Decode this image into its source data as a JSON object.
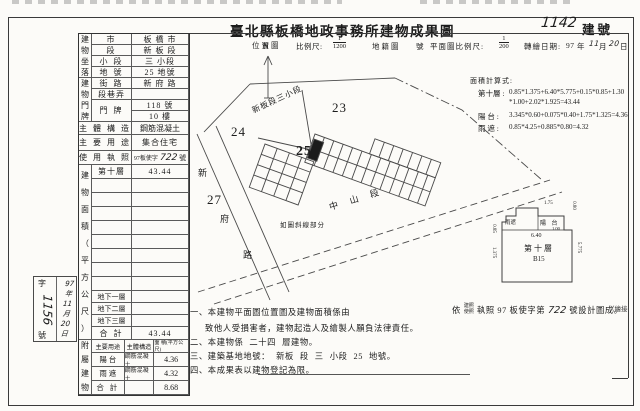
{
  "document": {
    "title": "臺北縣板橋地政事務所建物成果圖",
    "building_number": "1142",
    "building_number_label": "建號"
  },
  "scalebar": {
    "location_map": "位置圖",
    "scale_label": "比例尺:",
    "scale1_num": "1",
    "scale1_den": "1200",
    "cadastral_map": "地籍圖",
    "no_suffix": "號",
    "plan_scale_label": "平面圖比例尺:",
    "scale2_num": "1",
    "scale2_den": "200",
    "redraw_label": "轉繪日期:",
    "date_year": "97",
    "date_year_unit": "年",
    "date_month": "11",
    "date_month_unit": "月",
    "date_day": "20",
    "date_day_unit": "日"
  },
  "table": {
    "location": {
      "header": "建\n物\n坐\n落",
      "rows": [
        {
          "label": "市",
          "value": "板 橋 市"
        },
        {
          "label": "段",
          "value": "新 板 段"
        },
        {
          "label": "小 段",
          "value": "三 小段"
        },
        {
          "label": "地 號",
          "value": "25 地號"
        }
      ]
    },
    "address": {
      "header": "建\n物\n門\n牌",
      "street_label": "街 路",
      "street_value": "新 府 路",
      "lane_label": "段巷弄",
      "lane_value": "",
      "door_label": "門 牌",
      "door_value1": "118 號",
      "door_value2": "10 樓"
    },
    "structure": {
      "label": "主 體 構 造",
      "value": "鋼筋混凝土"
    },
    "usage": {
      "label": "主 要 用 途",
      "value": "集合住宅"
    },
    "license": {
      "label": "使 用 執 照",
      "prefix": "97板使字",
      "number": "722",
      "suffix": "號"
    },
    "area": {
      "header": "建\n物\n面\n積\n（\n平\n方\n公\n尺\n）",
      "floor_label": "第十層",
      "floor_value": "43.44",
      "b1": "地下一層",
      "b2": "地下二層",
      "b3": "地下三層",
      "total_label": "合  計",
      "total_value": "43.44"
    },
    "annex": {
      "header": "附\n屬\n建\n物",
      "col1": "主要用途",
      "col2": "主體構造",
      "col3": "面 積(平方公尺)",
      "rows": [
        {
          "use": "陽  台",
          "structure": "鋼筋混凝土",
          "area": "4.36"
        },
        {
          "use": "雨  遮",
          "structure": "鋼筋混凝土",
          "area": "4.32"
        }
      ],
      "total_label": "合  計",
      "total_value": "8.68"
    }
  },
  "calc": {
    "title": "面積計算式:",
    "floor_label": "第十層 :",
    "floor_formula1": "0.85*1.375+6.40*5.775+0.15*0.85+1.30",
    "floor_formula2": "*1.00+2.02*1.925=43.44",
    "balcony_label": "陽  台 :",
    "balcony_formula": "3.345*0.60+0.075*0.40+1.75*1.325=4.36",
    "canopy_label": "雨  遮 :",
    "canopy_formula": "0.85*4.25+0.885*0.80=4.32"
  },
  "map": {
    "compass": "N",
    "section_label": "新板段三小段",
    "parcel_23": "23",
    "parcel_24": "24",
    "parcel_25": "25",
    "parcel_27": "27",
    "road_zhongshan": "中 山 段",
    "road_xinfu": [
      "新",
      "府",
      "路"
    ],
    "hatch_note": "如圖斜線部分"
  },
  "floorplan": {
    "floor": "第十層",
    "unit": "B15",
    "balcony": "陽 台",
    "canopy": "雨遮",
    "dim_640": "6.40",
    "dim_175": "1.75",
    "dim_080": "0.80",
    "dim_100": "1.00",
    "dim_5775": "5.775",
    "dim_1375": "1.375",
    "dim_085": "0.85"
  },
  "notes": {
    "n1_start": "一、本建物平面圖位置圖及建物面積係由",
    "n1_yi": "依",
    "n1_building_permit": "建照",
    "n1_use_permit": "使照",
    "n1_mid": "執照 97 板使字第",
    "n1_number": "722",
    "n1_end": "號設計圖成。",
    "n1_line2": "致他人受損害者，建物起造人及繪製人願負法律責任。",
    "n2_start": "二、本建物係",
    "n2_floors": "二十四",
    "n2_end": "層建物。",
    "n3_start": "三、建築基地地號：",
    "n3_sec": "新板",
    "n3_mid1": "段",
    "n3_small": "三",
    "n3_mid2": "小段",
    "n3_no": "25",
    "n3_end": "地號。",
    "n4": "四、本成果表以建物登記為限。",
    "continuation": "（繪接"
  },
  "stamp": {
    "prefix": "字",
    "number": "1156",
    "suffix": "號",
    "date": "97\n年\n11\n月\n20\n日"
  }
}
